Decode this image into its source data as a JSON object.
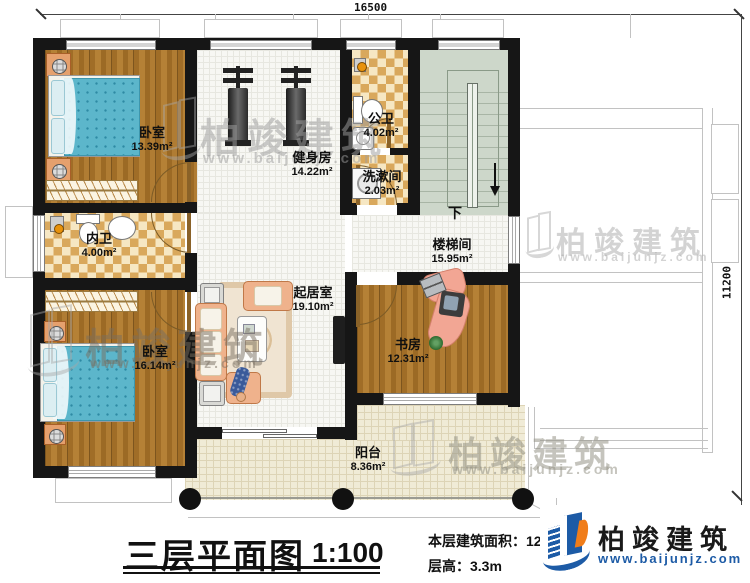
{
  "dimensions": {
    "width_label": "16500",
    "height_label": "11200"
  },
  "rooms": {
    "bedroom_top": {
      "label": "卧室",
      "area": "13.39m²"
    },
    "gym": {
      "label": "健身房",
      "area": "14.22m²"
    },
    "public_bath": {
      "label": "公卫",
      "area": "4.02m²"
    },
    "washroom": {
      "label": "洗漱间",
      "area": "2.03m²"
    },
    "private_bath": {
      "label": "内卫",
      "area": "4.00m²"
    },
    "stairwell": {
      "label": "楼梯间",
      "area": "15.95m²",
      "direction": "下"
    },
    "living": {
      "label": "起居室",
      "area": "19.10m²"
    },
    "study": {
      "label": "书房",
      "area": "12.31m²"
    },
    "bedroom_bottom": {
      "label": "卧室",
      "area": "16.14m²"
    },
    "balcony": {
      "label": "阳台",
      "area": "8.36m²"
    }
  },
  "title_block": {
    "plan_title": "三层平面图",
    "scale": "1:100",
    "area_label": "本层建筑面积：129.22㎡",
    "floor_height_label": "层高：3.3m"
  },
  "brand": {
    "name": "柏竣建筑",
    "website": "www.baijunjz.com",
    "accent_blue": "#1d5ba6",
    "accent_orange": "#f07d1a"
  },
  "watermark": {
    "name": "柏竣建筑",
    "website": "www.baijunjz.com"
  }
}
